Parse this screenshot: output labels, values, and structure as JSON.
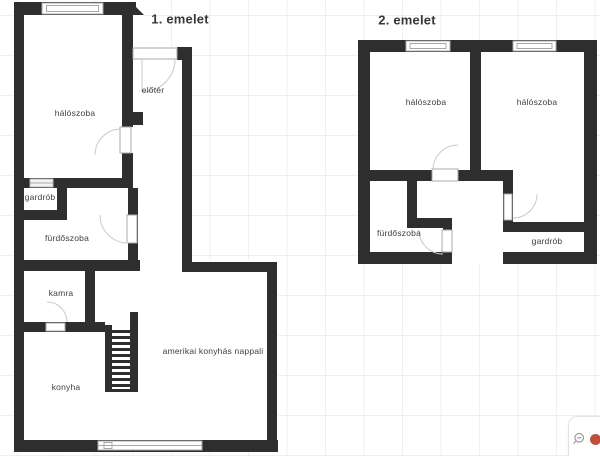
{
  "floor1": {
    "title": "1. emelet",
    "rooms": {
      "bedroom": "hálószoba",
      "hall": "előtér",
      "wardrobe": "gardrób",
      "bathroom": "fürdőszoba",
      "pantry": "kamra",
      "kitchen": "konyha",
      "living": "amerikai konyhás nappali"
    }
  },
  "floor2": {
    "title": "2. emelet",
    "rooms": {
      "bedroom_left": "hálószoba",
      "bedroom_right": "hálószoba",
      "bathroom": "fürdőszoba",
      "wardrobe": "gardrób"
    }
  },
  "controls": {
    "zoom_out_icon": "magnifier-minus"
  },
  "colors": {
    "wall": "#2e2e2e",
    "grid": "#f1eef0",
    "accent": "#c0503c"
  }
}
